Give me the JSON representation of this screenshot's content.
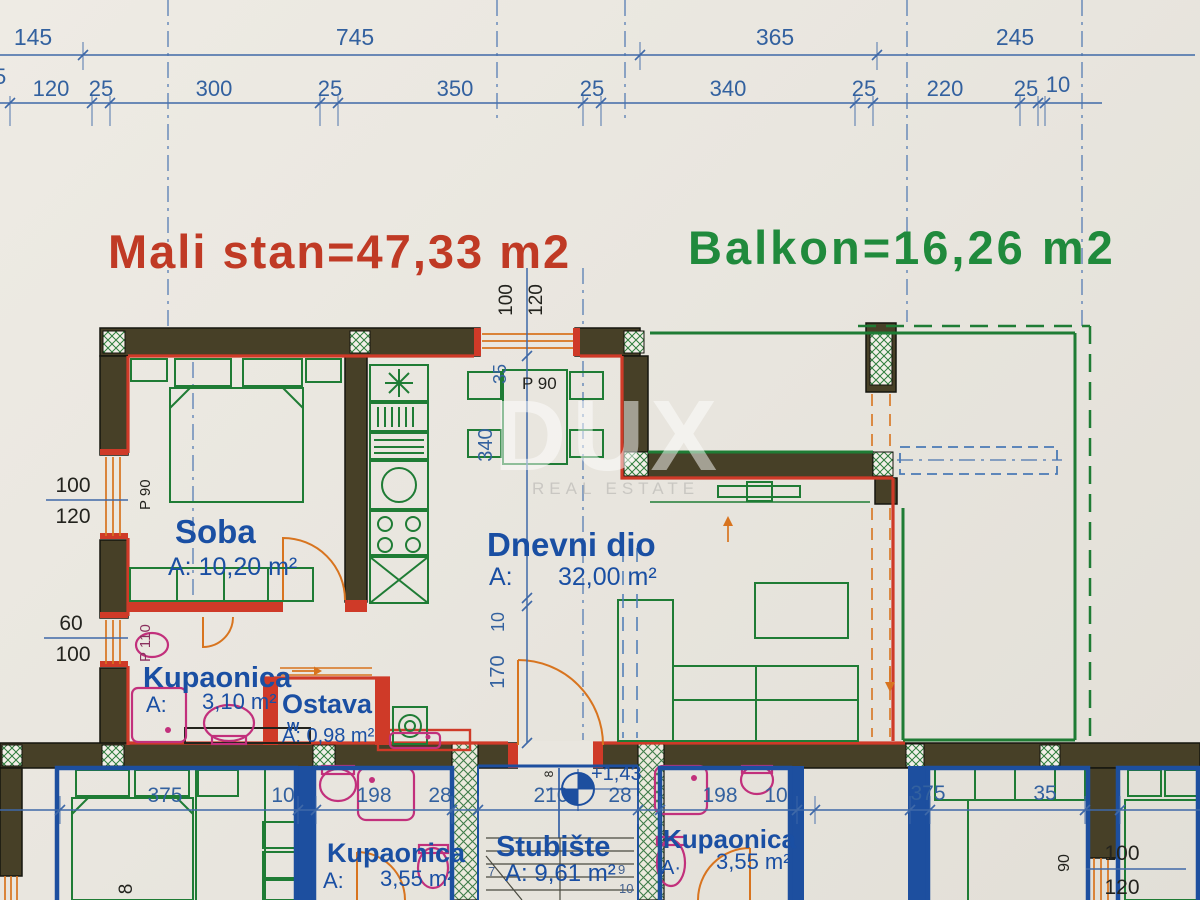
{
  "titles": {
    "apartment": "Mali stan=47,33 m2",
    "balcony": "Balkon=16,26 m2"
  },
  "watermark": {
    "brand": "DUX",
    "tagline": "REAL ESTATE"
  },
  "colors": {
    "dim_blue": "#33619f",
    "wall_red": "#cf3a28",
    "furniture_green": "#1f7c35",
    "title_red": "#c03a25",
    "title_green": "#208a3c",
    "wall_fill": "#474027",
    "lower_wall_blue": "#1d4f9f",
    "fixture_magenta": "#c2307c",
    "door_orange": "#d8741f",
    "label_blue": "#1a4fa3"
  },
  "dims": {
    "row1": [
      "145",
      "745",
      "365",
      "245"
    ],
    "row2": [
      "25",
      "120",
      "25",
      "300",
      "25",
      "350",
      "25",
      "340",
      "25",
      "220",
      "25",
      "10"
    ],
    "bottom": [
      "375",
      "10",
      "198",
      "28",
      "210",
      "28",
      "198",
      "10",
      "375",
      "35"
    ],
    "vertical_center": [
      "340",
      "10",
      "170"
    ],
    "top_center": {
      "w1": "100",
      "w2": "120",
      "win": "35"
    },
    "left_window": {
      "top": "100",
      "bottom": "120"
    },
    "left_door": {
      "top": "60",
      "bottom": "100"
    },
    "right_window": {
      "top": "100",
      "bottom": "120",
      "rot": "90"
    },
    "misc_stair": "8",
    "misc_left": "8"
  },
  "openings": {
    "top_window": "P 90",
    "left_window": "P 90",
    "left_door": "P 110"
  },
  "rooms": {
    "soba": {
      "name": "Soba",
      "area": "A: 10,20 m²"
    },
    "dnevni": {
      "name": "Dnevni dio",
      "a": "A:",
      "area": "32,00 m²"
    },
    "kupaonica1": {
      "name": "Kupaonica",
      "a": "A:",
      "area": "3,10 m²"
    },
    "ostava": {
      "name": "Ostava",
      "w": "W",
      "area": "A: 0,98 m²"
    },
    "kupaonica2": {
      "name": "Kupaonica",
      "a": "A:",
      "area": "3,55 m²"
    },
    "stubiste": {
      "name": "Stubište",
      "area": "A: 9,61 m²",
      "steps": {
        "s7": "7",
        "s9": "9",
        "s10": "10"
      }
    },
    "kupaonica3": {
      "name": "Kupaonica",
      "a": "A·",
      "area": "3,55 m²"
    }
  },
  "elevation": "+1,43"
}
